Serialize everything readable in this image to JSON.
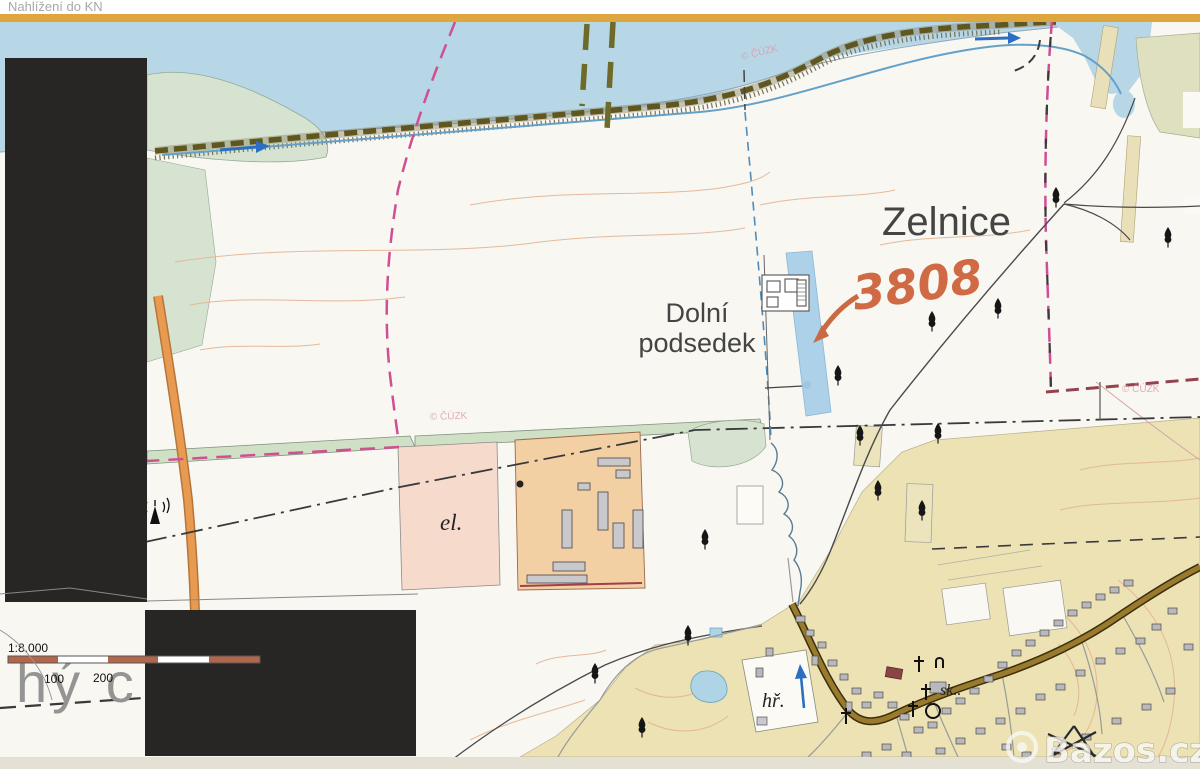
{
  "window": {
    "title": "Nahlížení do KN"
  },
  "map": {
    "place_label": "Zelnice",
    "locality_label": [
      "Dolní",
      "podsedek"
    ],
    "substation_label": "el.",
    "playground_label": "hř.",
    "school_label": "sk..",
    "background_sheet_text": "hý c",
    "copyright": "© ČÚZK",
    "annotation": {
      "parcel_number": "3808"
    },
    "scale_bar": {
      "ratio": "1:8.000",
      "tick_100": "100",
      "tick_200": "200"
    },
    "watermark": {
      "text": "Bazos.cz"
    },
    "colors": {
      "water": "#b7d7e7",
      "highlight_parcel": "#a9d0e8",
      "annotation_orange": "#cf6a45",
      "boundary_magenta": "#cf4f93",
      "border_orange": "#dda63e",
      "redaction_black": "#282624"
    }
  }
}
